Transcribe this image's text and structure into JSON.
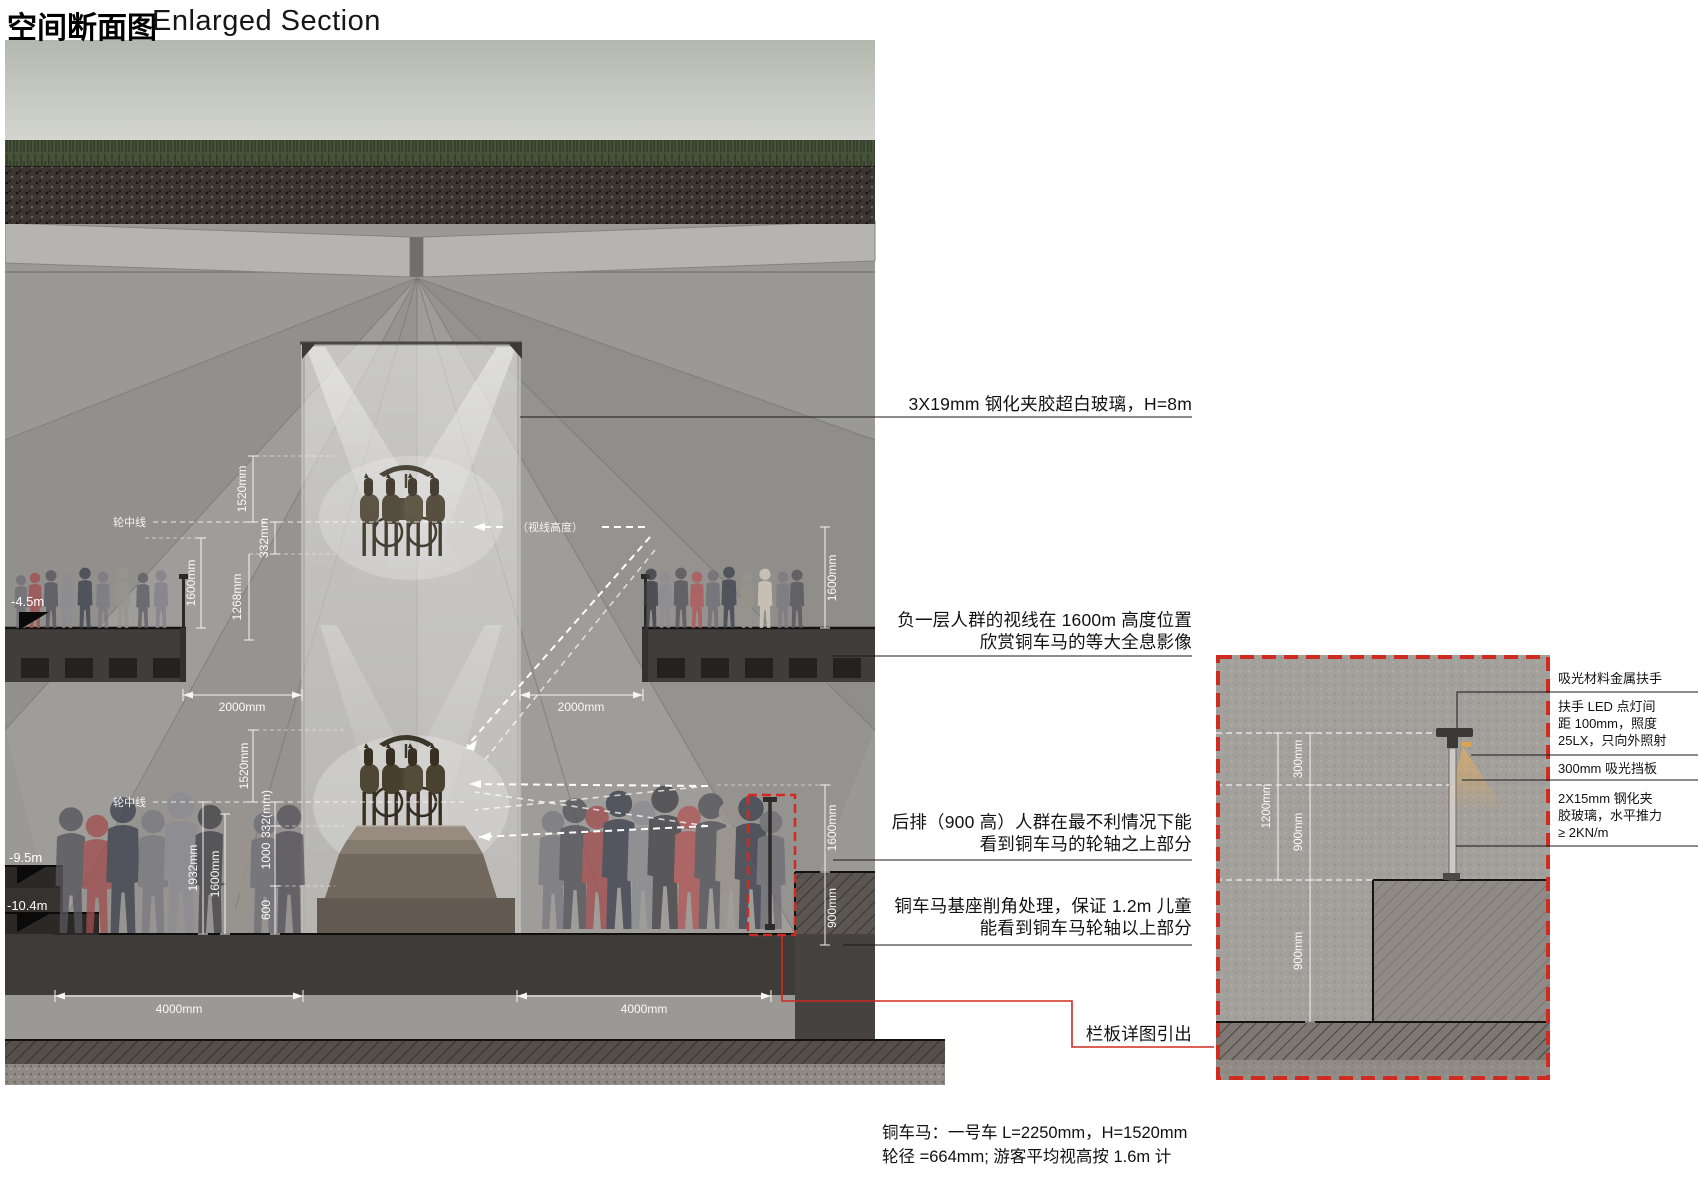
{
  "title": {
    "zh": "空间断面图",
    "en": "Enlarged Section"
  },
  "main": {
    "levels": {
      "b1": "-4.5m",
      "b2": "-9.5m",
      "b2b": "-10.4m"
    },
    "axis_labels": {
      "wheel_center_upper": "轮中线",
      "wheel_center_lower": "轮中线",
      "sight_height": "（视线高度）"
    },
    "dims": {
      "u_1520": "1520mm",
      "u_332": "332mm",
      "u_1268": "1268mm",
      "u_1600_left": "1600mm",
      "u_1600_right": "1600mm",
      "u_2000_left": "2000mm",
      "u_2000_right": "2000mm",
      "l_1520": "1520mm",
      "l_332": "332(mm)",
      "l_1000": "1000",
      "l_600": "600",
      "l_1932": "1932mm",
      "l_1600_left": "1600mm",
      "l_1600_right": "1600mm",
      "l_900_right": "900mm",
      "b_4000_left": "4000mm",
      "b_4000_right": "4000mm"
    }
  },
  "callouts": {
    "glass": "3X19mm 钢化夹胶超白玻璃，H=8m",
    "b1_sight_1": "负一层人群的视线在 1600m 高度位置",
    "b1_sight_2": "欣赏铜车马的等大全息影像",
    "back_row_1": "后排（900 高）人群在最不利情况下能",
    "back_row_2": "看到铜车马的轮轴之上部分",
    "pedestal_1": "铜车马基座削角处理，保证 1.2m 儿童",
    "pedestal_2": "能看到铜车马轮轴以上部分",
    "railing_detail_ref": "栏板详图引出"
  },
  "detail": {
    "dims": {
      "d300": "300mm",
      "d900_top": "900mm",
      "d1200": "1200mm",
      "d900_bottom": "900mm"
    },
    "notes": {
      "handrail": "吸光材料金属扶手",
      "led_1": "扶手 LED 点灯间",
      "led_2": "距 100mm，照度",
      "led_3": "25LX，只向外照射",
      "baffle": "300mm 吸光挡板",
      "glass_1": "2X15mm 钢化夹",
      "glass_2": "胶玻璃，水平推力",
      "glass_3": "≥ 2KN/m"
    }
  },
  "footnote": {
    "line1": "铜车马：一号车 L=2250mm，H=1520mm",
    "line2": "轮径 =664mm; 游客平均视高按 1.6m 计"
  },
  "colors": {
    "accent_red": "#cf2b20",
    "led": "#e5a94f",
    "dim_text": "#ffffff",
    "note_text": "#121212"
  }
}
